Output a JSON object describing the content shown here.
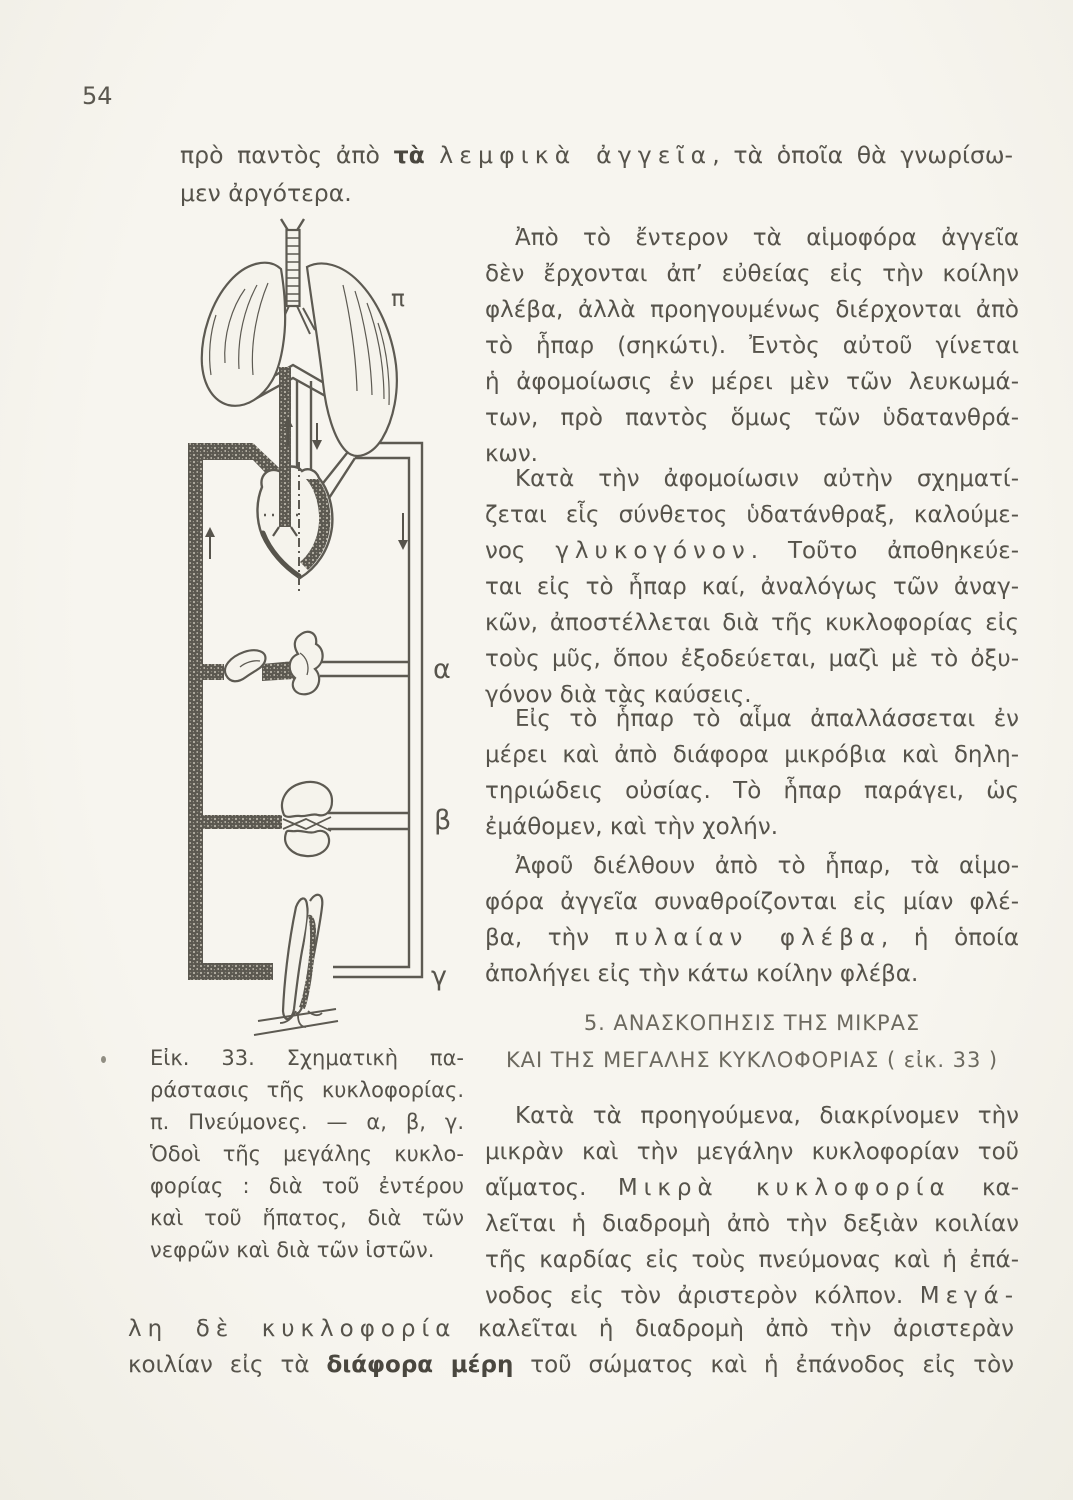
{
  "page": {
    "number": "54"
  },
  "colors": {
    "paper": "#f5f3ec",
    "ink": "#56534b",
    "ink_dark": "#4a473f",
    "heading": "#6c695f",
    "figure_line": "#5d5a52"
  },
  "intro": {
    "l1s1": "πρὸ παντὸς ἀπὸ ",
    "l1s2": "τὰ ",
    "l1s3": "λεμφικὰ ἀγγεῖα",
    "l1s4": ", τὰ ὁποῖα θὰ γνωρίσω-",
    "l2": "μεν ἀργότερα."
  },
  "column": {
    "para1": {
      "lines": [
        "Ἀπὸ τὸ ἔντερον τὰ αἱμοφόρα ἀγγεῖα",
        "δὲν ἔρχονται ἀπ’ εὐθείας εἰς τὴν κοίλην",
        "φλέβα, ἀλλὰ προηγουμένως διέρχονται ἀπὸ",
        "τὸ ἧπαρ (σηκώτι). Ἐντὸς αὐτοῦ γίνεται",
        "ἡ ἀφομοίωσις ἐν μέρει μὲν τῶν λευκωμά-",
        "των, πρὸ παντὸς ὅμως τῶν ὑδατανθρά-",
        "κων."
      ]
    },
    "para2": {
      "l1": "Κατὰ τὴν ἀφομοίωσιν αὐτὴν σχηματί-",
      "l2": "ζεται εἷς σύνθετος ὑδατάνθραξ, καλούμε-",
      "l3a": "νος ",
      "l3b": "γλυκογόνον",
      "l3c": ". Τοῦτο ἀποθηκεύε-",
      "l4": "ται εἰς τὸ ἧπαρ καί, ἀναλόγως τῶν ἀναγ-",
      "l5": "κῶν, ἀποστέλλεται διὰ τῆς κυκλοφορίας εἰς",
      "l6": "τοὺς μῦς, ὅπου ἐξοδεύεται, μαζὶ μὲ τὸ ὀξυ-",
      "l7": "γόνον διὰ τὰς καύσεις."
    },
    "para3": {
      "lines": [
        "Εἰς τὸ ἧπαρ τὸ αἷμα ἀπαλλάσσεται ἐν",
        "μέρει καὶ ἀπὸ διάφορα μικρόβια καὶ δηλη-",
        "τηριώδεις οὐσίας. Τὸ ἧπαρ παράγει, ὡς",
        "ἐμάθομεν, καὶ τὴν χολήν."
      ]
    },
    "para4": {
      "l1": "Ἀφοῦ διέλθουν ἀπὸ τὸ ἧπαρ, τὰ αἱμο-",
      "l2": "φόρα ἀγγεῖα συναθροίζονται εἰς μίαν φλέ-",
      "l3a": "βα, τὴν ",
      "l3b": "πυλαίαν φλέβα",
      "l3c": ", ἡ ὁποία",
      "l4": "ἀπολήγει εἰς τὴν κάτω κοίλην φλέβα."
    },
    "para5": {
      "l1": "Κατὰ τὰ προηγούμενα, διακρίνομεν τὴν",
      "l2": "μικρὰν καὶ τὴν μεγάλην κυκλοφορίαν τοῦ",
      "l3a": "αἵματος. ",
      "l3b": "Μικρὰ κυκλοφορία",
      "l3c": " κα-",
      "l4": "λεῖται ἡ διαδρομὴ ἀπὸ τὴν δεξιὰν κοιλίαν",
      "l5": "τῆς καρδίας εἰς τοὺς πνεύμονας καὶ ἡ ἐπά-",
      "l6a": "νοδος εἰς τὸν ἀριστερὸν κόλπον. ",
      "l6b": "Μεγά-"
    }
  },
  "heading": {
    "line1": "5. ΑΝΑΣΚΟΠΗΣΙΣ ΤΗΣ ΜΙΚΡΑΣ",
    "line2": "ΚΑΙ ΤΗΣ ΜΕΓΑΛΗΣ ΚΥΚΛΟΦΟΡΙΑΣ ( εἰκ. 33 )"
  },
  "bottom": {
    "l1a": "λη δὲ κυκλοφορία",
    "l1b": " καλεῖται ἡ διαδρομὴ ἀπὸ τὴν ἀριστερὰν",
    "l2a": "κοιλίαν εἰς τὰ ",
    "l2b": "διάφορα μέρη",
    "l2c": " τοῦ σώματος καὶ ἡ ἐπάνοδος εἰς τὸν"
  },
  "caption": {
    "lines": [
      "Εἰκ. 33. Σχηματικὴ πα-",
      "ράστασις τῆς κυκλοφορίας.",
      "π. Πνεύμονες. — α, β, γ.",
      "Ὁδοὶ τῆς μεγάλης κυκλο-",
      "φορίας : διὰ τοῦ ἐντέρου",
      "καὶ τοῦ ἥπατος, διὰ τῶν",
      "νεφρῶν καὶ διὰ τῶν ἱστῶν."
    ]
  },
  "figure": {
    "labels": {
      "pi": "π",
      "alpha": "α",
      "beta": "β",
      "gamma": "γ"
    }
  }
}
